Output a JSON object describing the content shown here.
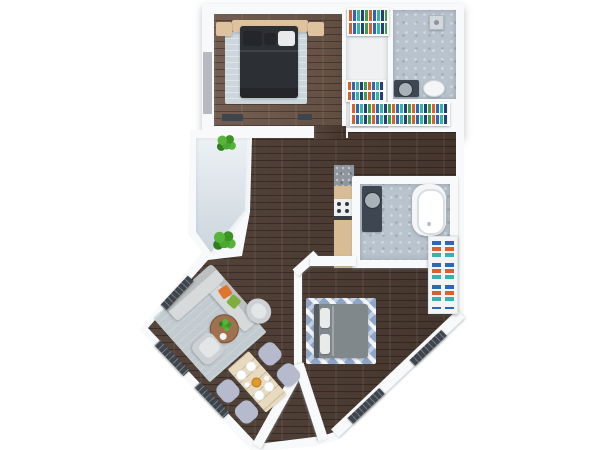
{
  "scene": {
    "title": "apartment-floor-plan-3d-top-view",
    "background": "#ffffff",
    "rooms": [
      {
        "name": "bedroom-1",
        "floor": "wood-light-brown",
        "furniture": [
          "double-bed-dark",
          "headboard-panel",
          "nightstand-left",
          "nightstand-right",
          "area-rug-light-blue",
          "dresser",
          "window"
        ]
      },
      {
        "name": "walk-in-closet",
        "floor": "white",
        "furniture": [
          "clothes-rack-top",
          "clothes-rack-middle",
          "clothes-rack-wide"
        ]
      },
      {
        "name": "shower-room",
        "floor": "tile-gray",
        "furniture": [
          "shower-fixture",
          "vanity-with-sink",
          "toilet"
        ]
      },
      {
        "name": "hallway",
        "floor": "wood-dark-brown",
        "furniture": []
      },
      {
        "name": "kitchen",
        "floor": "wood-dark-brown",
        "furniture": [
          "granite-counter",
          "cabinet",
          "stove",
          "cabinet"
        ]
      },
      {
        "name": "bathroom",
        "floor": "tile-gray",
        "furniture": [
          "bathtub",
          "vanity-with-sink"
        ]
      },
      {
        "name": "bedroom-2",
        "floor": "wood-dark-brown",
        "furniture": [
          "double-bed-gray",
          "chevron-rug",
          "wardrobe-shelves",
          "window-radiators"
        ]
      },
      {
        "name": "living-room",
        "floor": "wood-dark-brown",
        "furniture": [
          "l-shaped-sofa",
          "throw-pillows",
          "coffee-table",
          "potted-plant",
          "armchair-round",
          "armchair",
          "area-rug",
          "window-radiators"
        ]
      },
      {
        "name": "dining-area",
        "floor": "wood-dark-brown",
        "furniture": [
          "dining-table",
          "chair",
          "chair",
          "chair",
          "chair",
          "plates",
          "centerpiece"
        ]
      },
      {
        "name": "balcony",
        "floor": "light-gray",
        "furniture": [
          "potted-plant",
          "potted-plant",
          "glass-wall"
        ]
      }
    ],
    "colors": {
      "wall": "#f8f9fa",
      "floor_wood_dark": "#4c3b31",
      "floor_wood_light": "#6e5749",
      "floor_tile": "#b9c3cd",
      "floor_closet": "#eff1f3",
      "balcony_floor": "#dce4eb",
      "rug_light": "#ccd7dc",
      "rug_chevron": "#90a6c6",
      "bed1_duvet": "#2c2f33",
      "bed1_pillow_dark": "#24262a",
      "bed2_duvet": "#81888c",
      "fixture_white": "#f3f5f6",
      "pillow_white": "#e9ebeb",
      "headboard_tan": "#dfc29e",
      "sofa": "#d6dadb",
      "armchair": "#cdd1d3",
      "coffee_table": "#a0714e",
      "dining_table": "#e8dabe",
      "chair_lavender": "#b6bacd",
      "tub_white": "#f3f5f6",
      "vanity_dark": "#3e4651",
      "sink_gray": "#a9b2b9",
      "granite": "#8f969f",
      "cabinet_wood": "#d9bc94",
      "stove_white": "#edeff0",
      "radiator_dark": "#3f454d",
      "window_gray": "#b6bac0",
      "pillow_orange": "#e0762e",
      "pillow_green": "#7fae3f",
      "centerpiece_orange": "#e09a2d",
      "clothes_palette": [
        "#d9622c",
        "#2f66b8",
        "#35b3ad",
        "#27406e",
        "#3f9e4d"
      ]
    }
  }
}
